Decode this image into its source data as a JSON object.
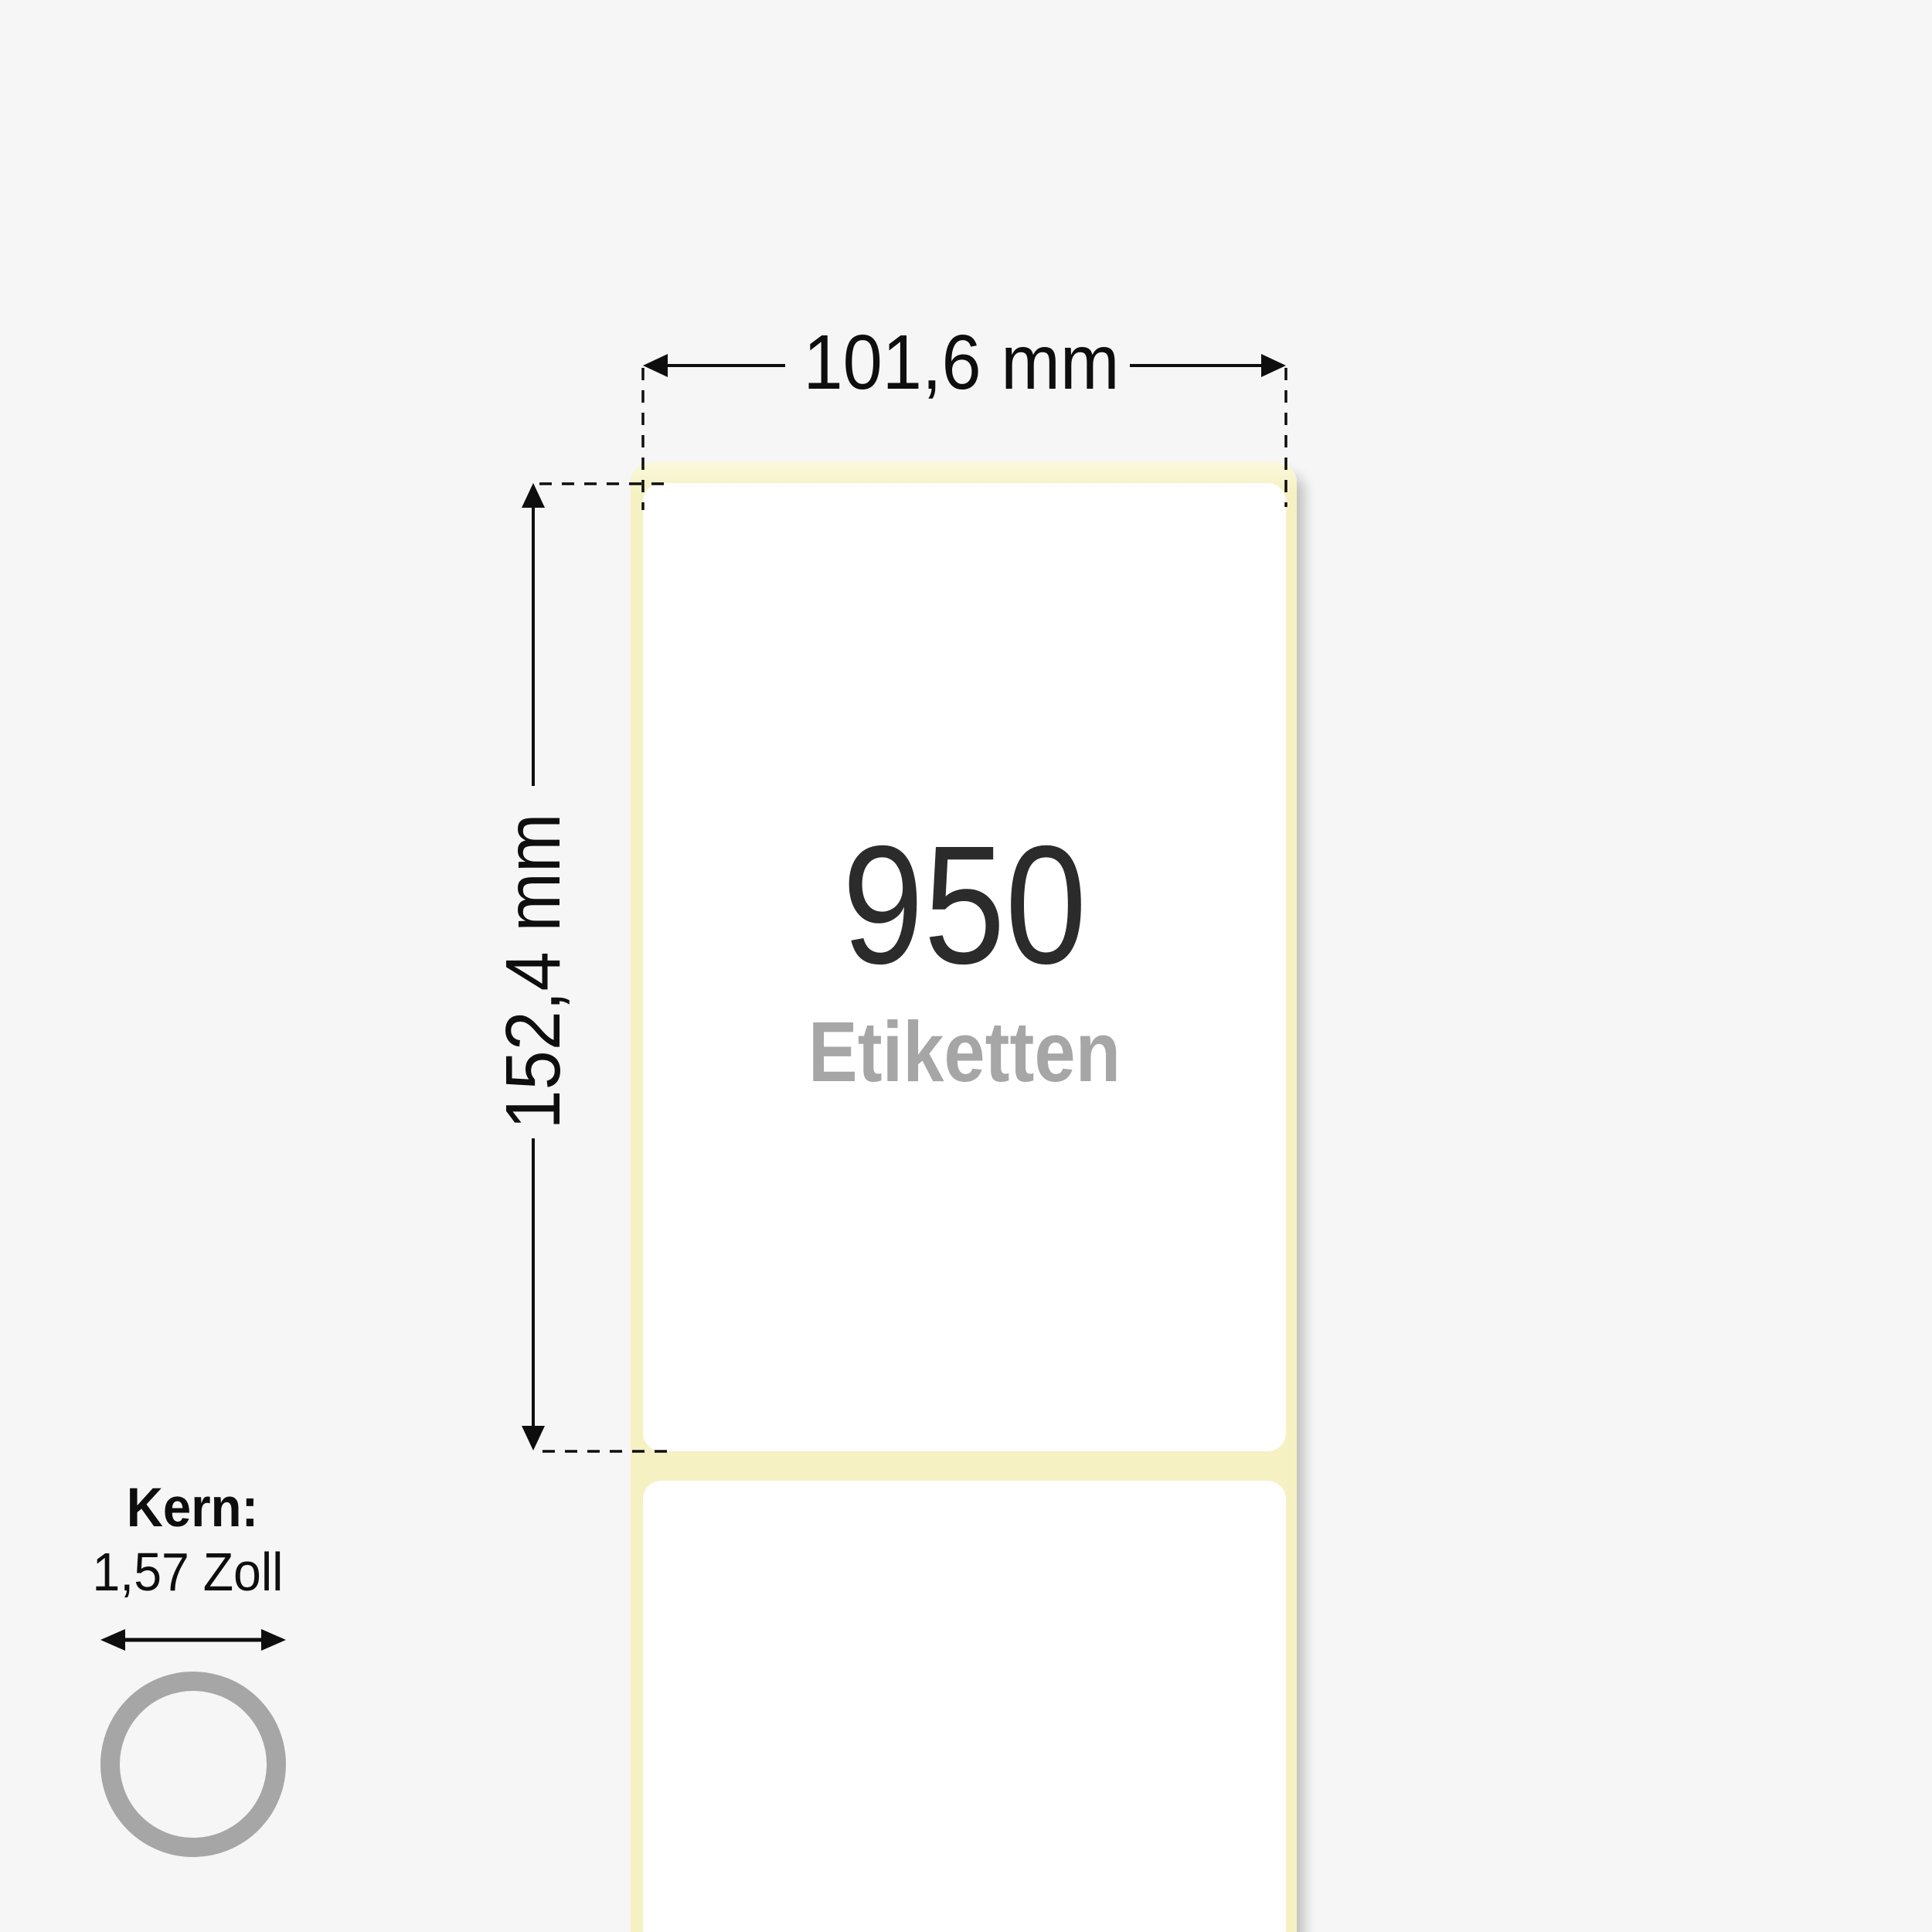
{
  "diagram": {
    "width_dimension": "101,6 mm",
    "height_dimension": "152,4 mm",
    "label_count": "950",
    "label_count_unit": "Etiketten",
    "core_title": "Kern:",
    "core_size": "1,57 Zoll"
  },
  "icons": {
    "core_ring": "core-ring-icon",
    "width_dimension_arrows": "horizontal-double-arrow-icon",
    "height_dimension_arrows": "vertical-double-arrow-icon",
    "core_diameter_arrow": "horizontal-double-arrow-icon"
  },
  "colors": {
    "background": "#f6f6f6",
    "liner": "#f5f1c3",
    "liner-highlight": "#faf8dc",
    "label": "#ffffff",
    "count-text": "#2b2b2b",
    "unit-text": "#a6a6a6",
    "line": "#0e0e0e",
    "ring": "#a6a6a6"
  }
}
